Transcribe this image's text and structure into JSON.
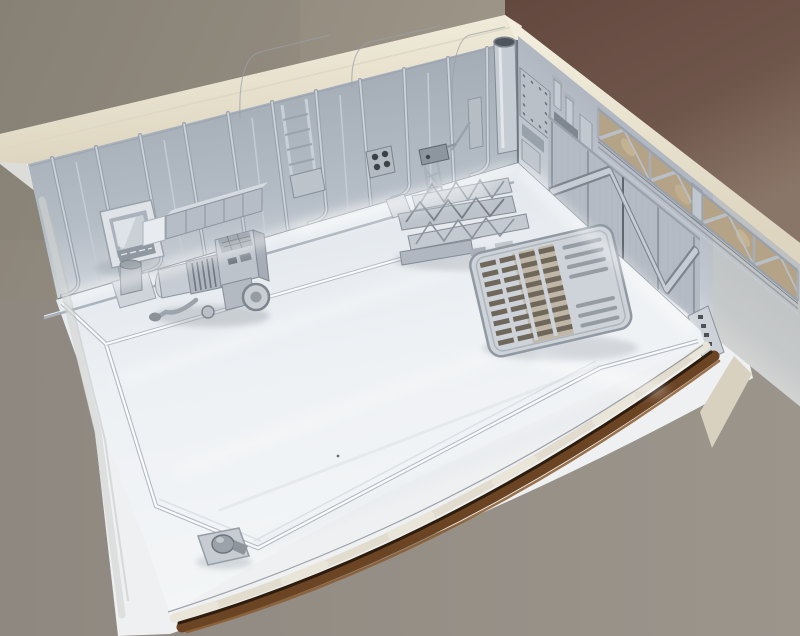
{
  "scene": {
    "description": "Photograph of an unpainted scale model diorama: the corner of a hangar interior primed in white and light grey, mounted on a wooden base, photographed over a tan and brown backdrop",
    "subject": "hangar-corner-diorama-model",
    "elements": [
      {
        "name": "backdrop-left",
        "color": "#8f887c"
      },
      {
        "name": "backdrop-right",
        "color": "#6b5147"
      },
      {
        "name": "diorama-base",
        "color": "#eef1f4"
      },
      {
        "name": "wood-trim",
        "color": "#6b4424"
      },
      {
        "name": "masking-tape",
        "color": "#ded8c8"
      },
      {
        "name": "wall-coping",
        "color": "#ece5d1"
      },
      {
        "name": "back-wall",
        "color": "#aab2bc"
      },
      {
        "name": "right-wall",
        "color": "#b7bec7"
      },
      {
        "name": "truss-girders",
        "color": "#b5a387"
      },
      {
        "name": "corrugated-doors",
        "color": "#b4bbc4"
      },
      {
        "name": "corner-pipe",
        "color": "#c0c7cf"
      },
      {
        "name": "wall-ladder",
        "color": "#c8cfd7"
      },
      {
        "name": "vent-block",
        "color": "#b3bac2"
      },
      {
        "name": "floor",
        "color": "#f0f3f5"
      },
      {
        "name": "floor-walkway-outline",
        "color": "#fbfcfd"
      },
      {
        "name": "monitor-console",
        "color": "#dfe3e8"
      },
      {
        "name": "crate-row",
        "color": "#c2c8d0"
      },
      {
        "name": "barrel",
        "color": "#b4bbc3"
      },
      {
        "name": "generator-cart",
        "color": "#b8bfc8"
      },
      {
        "name": "crane-tower",
        "color": "#a9b1ba"
      },
      {
        "name": "girder-pile",
        "color": "#c2c8d0"
      },
      {
        "name": "deck-grating-ramp",
        "color": "#cdd3d9"
      },
      {
        "name": "corner-fixture",
        "color": "#c6ccd2"
      }
    ]
  }
}
